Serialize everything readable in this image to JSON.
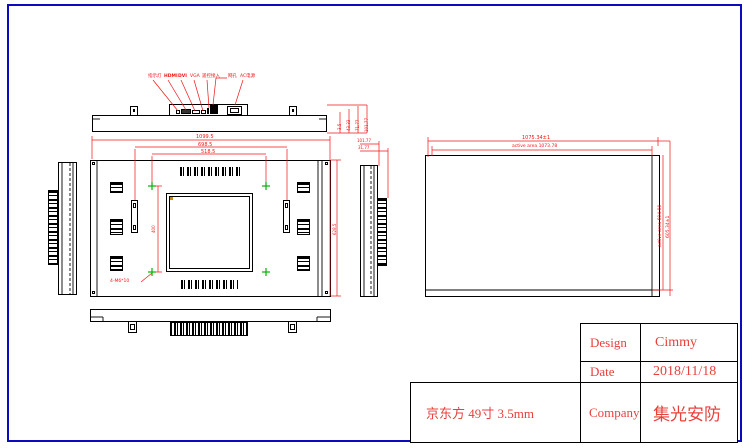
{
  "sheet": {
    "background": "#ffffff",
    "border_color": "#0a0ac0"
  },
  "colors": {
    "line": "#000000",
    "dimension": "#f01414",
    "vesa_marker": "#00b400",
    "title_text": "#e8403c"
  },
  "top_view": {
    "connector_labels": [
      "指示灯",
      "HDMI",
      "DVI",
      "VGA",
      "遥控接入",
      "网孔",
      "AC电源"
    ],
    "depth_dims": [
      "3.5",
      "43.33",
      "71.77",
      "101.77"
    ]
  },
  "back_view": {
    "width_dims": [
      "1099.5",
      "698.5",
      "518.5"
    ],
    "height_dim": "628.5",
    "vesa_dim": "400",
    "screw_note": "4-M6*10"
  },
  "side_view": {
    "depth_dims": [
      "101.77",
      "31.77"
    ]
  },
  "front_view": {
    "outline_width": "1075.34±1",
    "active_width": "active area 1073.78",
    "active_height": "active area 604.00",
    "outline_height": "605.34±1"
  },
  "title_block": {
    "rows": [
      {
        "label": "Design",
        "value": "Cimmy"
      },
      {
        "label": "Date",
        "value": "2018/11/18"
      },
      {
        "label": "Company",
        "value": "集光安防"
      }
    ],
    "product_label": "京东方 49寸 3.5mm"
  }
}
